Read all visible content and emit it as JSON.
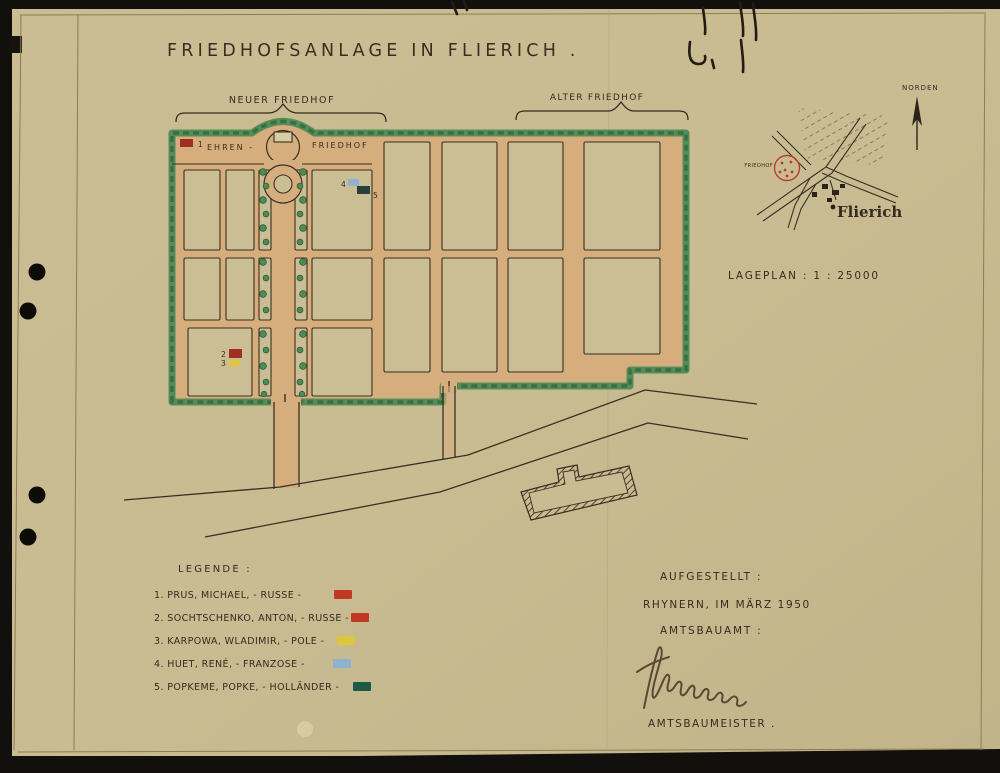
{
  "sheet": {
    "title": "FRIEDHOFSANLAGE   IN  FLIERICH ."
  },
  "plan": {
    "neuer_label": "NEUER  FRIEDHOF",
    "alter_label": "ALTER  FRIEDHOF",
    "ehren_left": "EHREN -",
    "ehren_right": "FRIEDHOF",
    "marker_1": "1",
    "marker_2": "2",
    "marker_3": "3",
    "marker_4": "4",
    "marker_5": "5"
  },
  "inset": {
    "north_label": "NORDEN",
    "stamp_label": "FRIEDHOF",
    "town_label": "Flierich",
    "scale_label": "LAGEPLAN :   1 : 25000"
  },
  "legend": {
    "heading": "LEGENDE :",
    "items": [
      {
        "label": "1. PRUS, MICHAEL, - RUSSE -",
        "color": "#bf3a24"
      },
      {
        "label": "2. SOCHTSCHENKO, ANTON, - RUSSE -",
        "color": "#bf3a24"
      },
      {
        "label": "3. KARPOWA, WLADIMIR, - POLE -",
        "color": "#ddc63e"
      },
      {
        "label": "4. HUET, RENÉ, - FRANZOSE -",
        "color": "#8fb2cf"
      },
      {
        "label": "5. POPKEME, POPKE, - HOLLÄNDER -",
        "color": "#1c5a47"
      }
    ]
  },
  "footer": {
    "aufgestellt": "AUFGESTELLT :",
    "place_date": "RHYNERN, IM MÄRZ 1950",
    "amtsbauamt": "AMTSBAUAMT :",
    "amtsbaumeister": "AMTSBAUMEISTER ."
  },
  "colors": {
    "paper": "#c9bc92",
    "path_wash": "#d6ae7e",
    "hedge": "#4f8a57",
    "hedge_dark": "#38703f",
    "ink": "#352b1f",
    "plan_red": "#9e2f22",
    "plan_blue": "#8fb2cf",
    "plan_yellow": "#ddc63e",
    "plan_dark": "#27413a",
    "stamp_red": "#b5402e"
  }
}
